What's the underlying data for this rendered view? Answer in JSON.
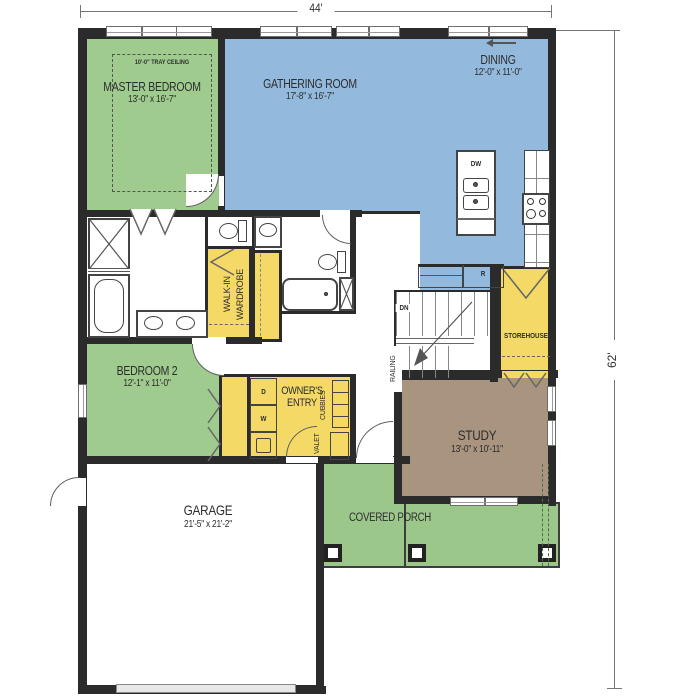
{
  "colors": {
    "bedroom_green": "#9fcb8e",
    "living_blue": "#93b9dc",
    "closet_yellow": "#f4d967",
    "study_brown": "#a9947f",
    "porch_green": "#9cc78b",
    "wall": "#2b2b2b"
  },
  "dimensions": {
    "overall_width": "44'",
    "overall_depth": "62'"
  },
  "rooms": {
    "master_bedroom": {
      "name": "MASTER BEDROOM",
      "dims": "13'-0\" x 16'-7\"",
      "tray_ceiling": "10'-0\" TRAY CEILING"
    },
    "gathering_room": {
      "name": "GATHERING ROOM",
      "dims": "17'-8\" x 16'-7\""
    },
    "dining": {
      "name": "DINING",
      "dims": "12'-0\" x 11'-0\""
    },
    "bedroom_2": {
      "name": "BEDROOM 2",
      "dims": "12'-1\" x 11'-0\""
    },
    "study": {
      "name": "STUDY",
      "dims": "13'-0\" x 10'-11\""
    },
    "garage": {
      "name": "GARAGE",
      "dims": "21'-5\" x 21'-2\""
    },
    "covered_porch": {
      "name": "COVERED PORCH"
    },
    "owners_entry": {
      "line1": "OWNER'S",
      "line2": "ENTRY"
    },
    "walk_in_wardrobe": {
      "line1": "WALK-IN",
      "line2": "WARDROBE"
    },
    "storehouse": {
      "name": "STOREHOUSE"
    }
  },
  "fixtures": {
    "dishwasher": "DW",
    "refrigerator": "R",
    "washer": "W",
    "dryer": "D",
    "stairs_down": "DN",
    "railing": "RAILING",
    "valet": "VALET",
    "cubbies": "CUBBIES"
  }
}
